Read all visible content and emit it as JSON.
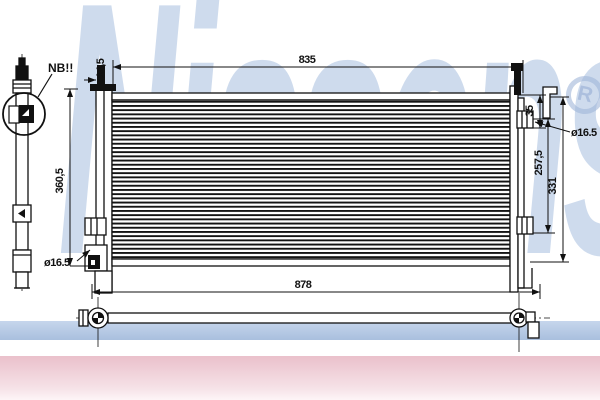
{
  "drawing": {
    "note_label": "NB!!",
    "dimensions": {
      "core_width": "835",
      "overall_width": "878",
      "left_height": "360,5",
      "right_height_total": "331",
      "right_port_span": "257,5",
      "top_port_offset": "35",
      "bracket_offset": "14,5",
      "port_diameter_right": "ø16.5",
      "port_diameter_left": "ø16.5"
    }
  },
  "watermark": {
    "brand": "Nissens",
    "registered_mark": "R",
    "color_text": "#a6bdde",
    "color_band_blue": "#a9bfde",
    "color_band_pink": "#eac0cb"
  }
}
